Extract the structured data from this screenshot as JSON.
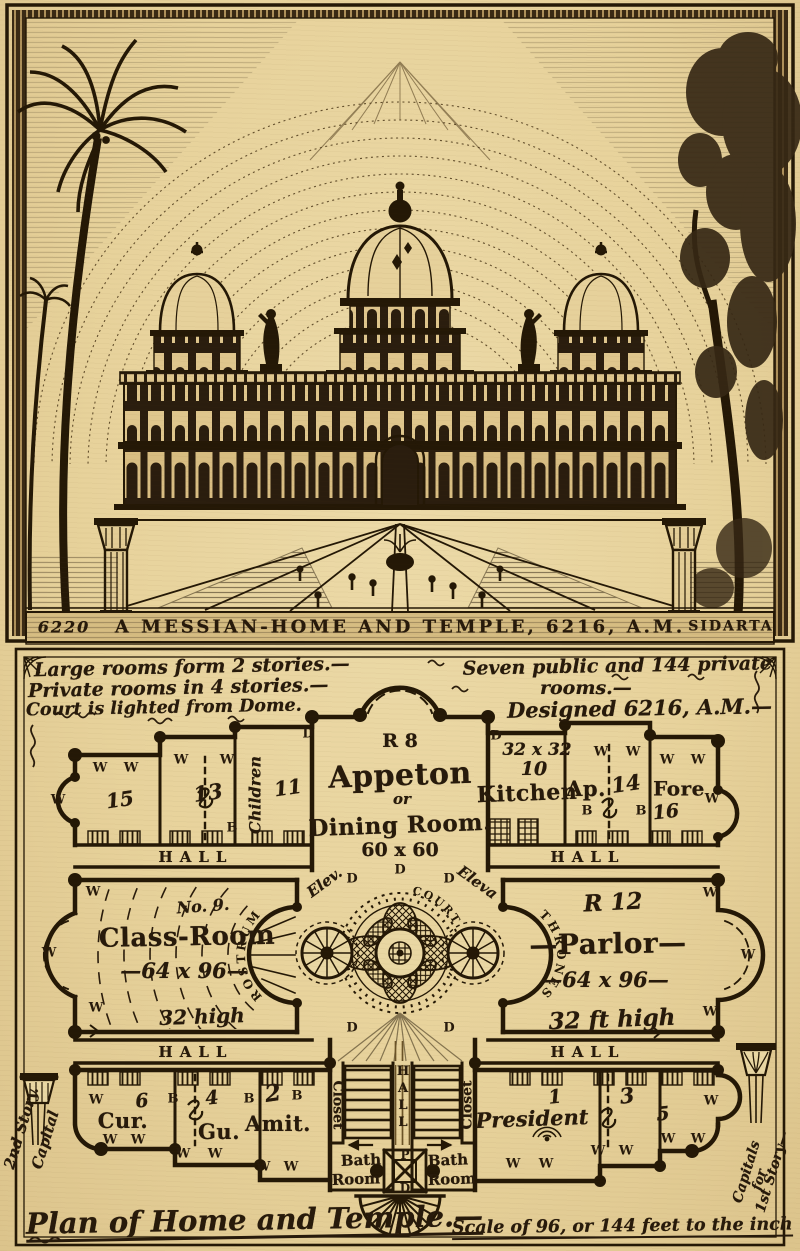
{
  "engraving": {
    "plate_left": "6220",
    "title": "A MESSIAN-HOME AND TEMPLE, 6216, A.M.",
    "plate_right": "SIDARTA"
  },
  "plan": {
    "notes_left": [
      "Large rooms form 2 stories.—",
      "Private rooms in 4 stories.—",
      "Court is lighted from Dome."
    ],
    "notes_right": [
      "Seven public and 144 private",
      "rooms.—",
      "Designed 6216, A.M.—"
    ],
    "hall": "HALL",
    "marks": {
      "w": "W",
      "b": "B",
      "d": "D",
      "p": "P"
    },
    "rooms": {
      "appeton": {
        "code": "R 8",
        "name": "Appeton",
        "conj": "or",
        "alt": "Dining Room.",
        "size": "60 x 60"
      },
      "n15": "15",
      "n13": "13",
      "n11": "11",
      "children": "Children",
      "kitchen": {
        "size": "32 x 32",
        "num": "10",
        "name": "Kitchen"
      },
      "ap": {
        "name": "Ap.",
        "num": "14"
      },
      "fore": {
        "name": "Fore",
        "num": "16"
      },
      "classroom": {
        "no": "No. 9.",
        "name": "Class-Room",
        "size": "—64 x 96—",
        "height": "32 high",
        "rostrum": "ROSTRUM"
      },
      "court": {
        "name": "COURT",
        "elev1": "Elev.",
        "elev2": "Eleva",
        "thrones": "THRONES"
      },
      "parlor": {
        "code": "R 12",
        "name": "—Parlor—",
        "size": "—64 x 96—",
        "height": "32 ft high"
      },
      "cur": {
        "name": "Cur.",
        "num": "6"
      },
      "gu": {
        "name": "Gu.",
        "num": "4"
      },
      "amit": {
        "name": "Amit.",
        "num": "2"
      },
      "president": {
        "name": "President",
        "num": "1"
      },
      "n3": "3",
      "n5": "5",
      "closet": "Closet",
      "bath1": "Bath",
      "bath2": "Room"
    },
    "margins": {
      "left": [
        "Capital",
        "2nd Story."
      ],
      "right": [
        "Capitals",
        "for",
        "1st Story—"
      ]
    },
    "footer": {
      "title": "Plan of Home and Temple.—",
      "scale": "Scale of 96, or 144 feet to the inch"
    }
  }
}
